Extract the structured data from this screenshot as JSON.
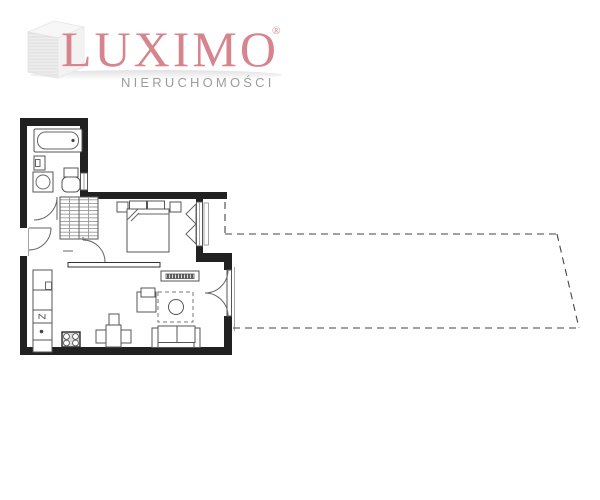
{
  "logo": {
    "brand": "LUXIMO",
    "registered": "®",
    "subtitle": "NIERUCHOMOŚCI",
    "brand_color": "#d6858e",
    "subtitle_color": "#9c9c9c",
    "icon": "building-3d-icon"
  },
  "plan": {
    "type": "apartment-floor-plan",
    "background_color": "#ffffff",
    "wall_color": "#212121",
    "furniture_line_color": "#555555",
    "balcony_outline_style": "dashed",
    "rooms": [
      {
        "name": "bathroom"
      },
      {
        "name": "hallway"
      },
      {
        "name": "bedroom"
      },
      {
        "name": "living-room-with-kitchenette"
      },
      {
        "name": "balcony"
      }
    ],
    "elements": [
      "bathtub",
      "bathroom-cabinet",
      "washbasin",
      "toilet",
      "bathroom-window",
      "bathroom-door",
      "entrance-door",
      "wardrobe",
      "bedroom-door",
      "double-bed",
      "pillows",
      "nightstand-left",
      "nightstand-right",
      "bedroom-window",
      "partition-wall",
      "tv-console",
      "armchair",
      "rug",
      "coffee-table",
      "sofa",
      "dining-table",
      "dining-chairs",
      "kitchen-counter",
      "fridge-unit",
      "sink-unit",
      "stove-four-burners",
      "balcony-french-door",
      "balcony-outline"
    ]
  }
}
